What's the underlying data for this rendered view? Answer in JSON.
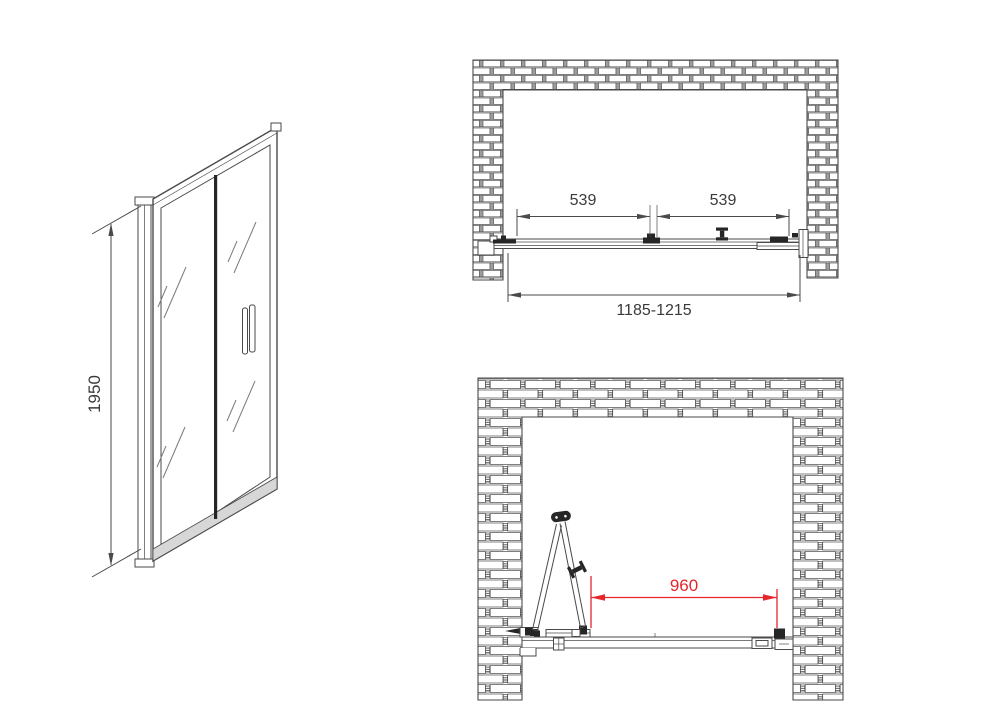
{
  "colors": {
    "line": "#4a4a4a",
    "ink": "#262626",
    "dimension_red": "#e5262b",
    "mortar_gray": "#9d9d9d"
  },
  "front_view": {
    "height_label": "1950"
  },
  "top_plan_view": {
    "left_door_width_label": "539",
    "right_door_width_label": "539",
    "overall_width_label": "1185-1215"
  },
  "open_plan_view": {
    "walk_in_width_label": "960"
  }
}
